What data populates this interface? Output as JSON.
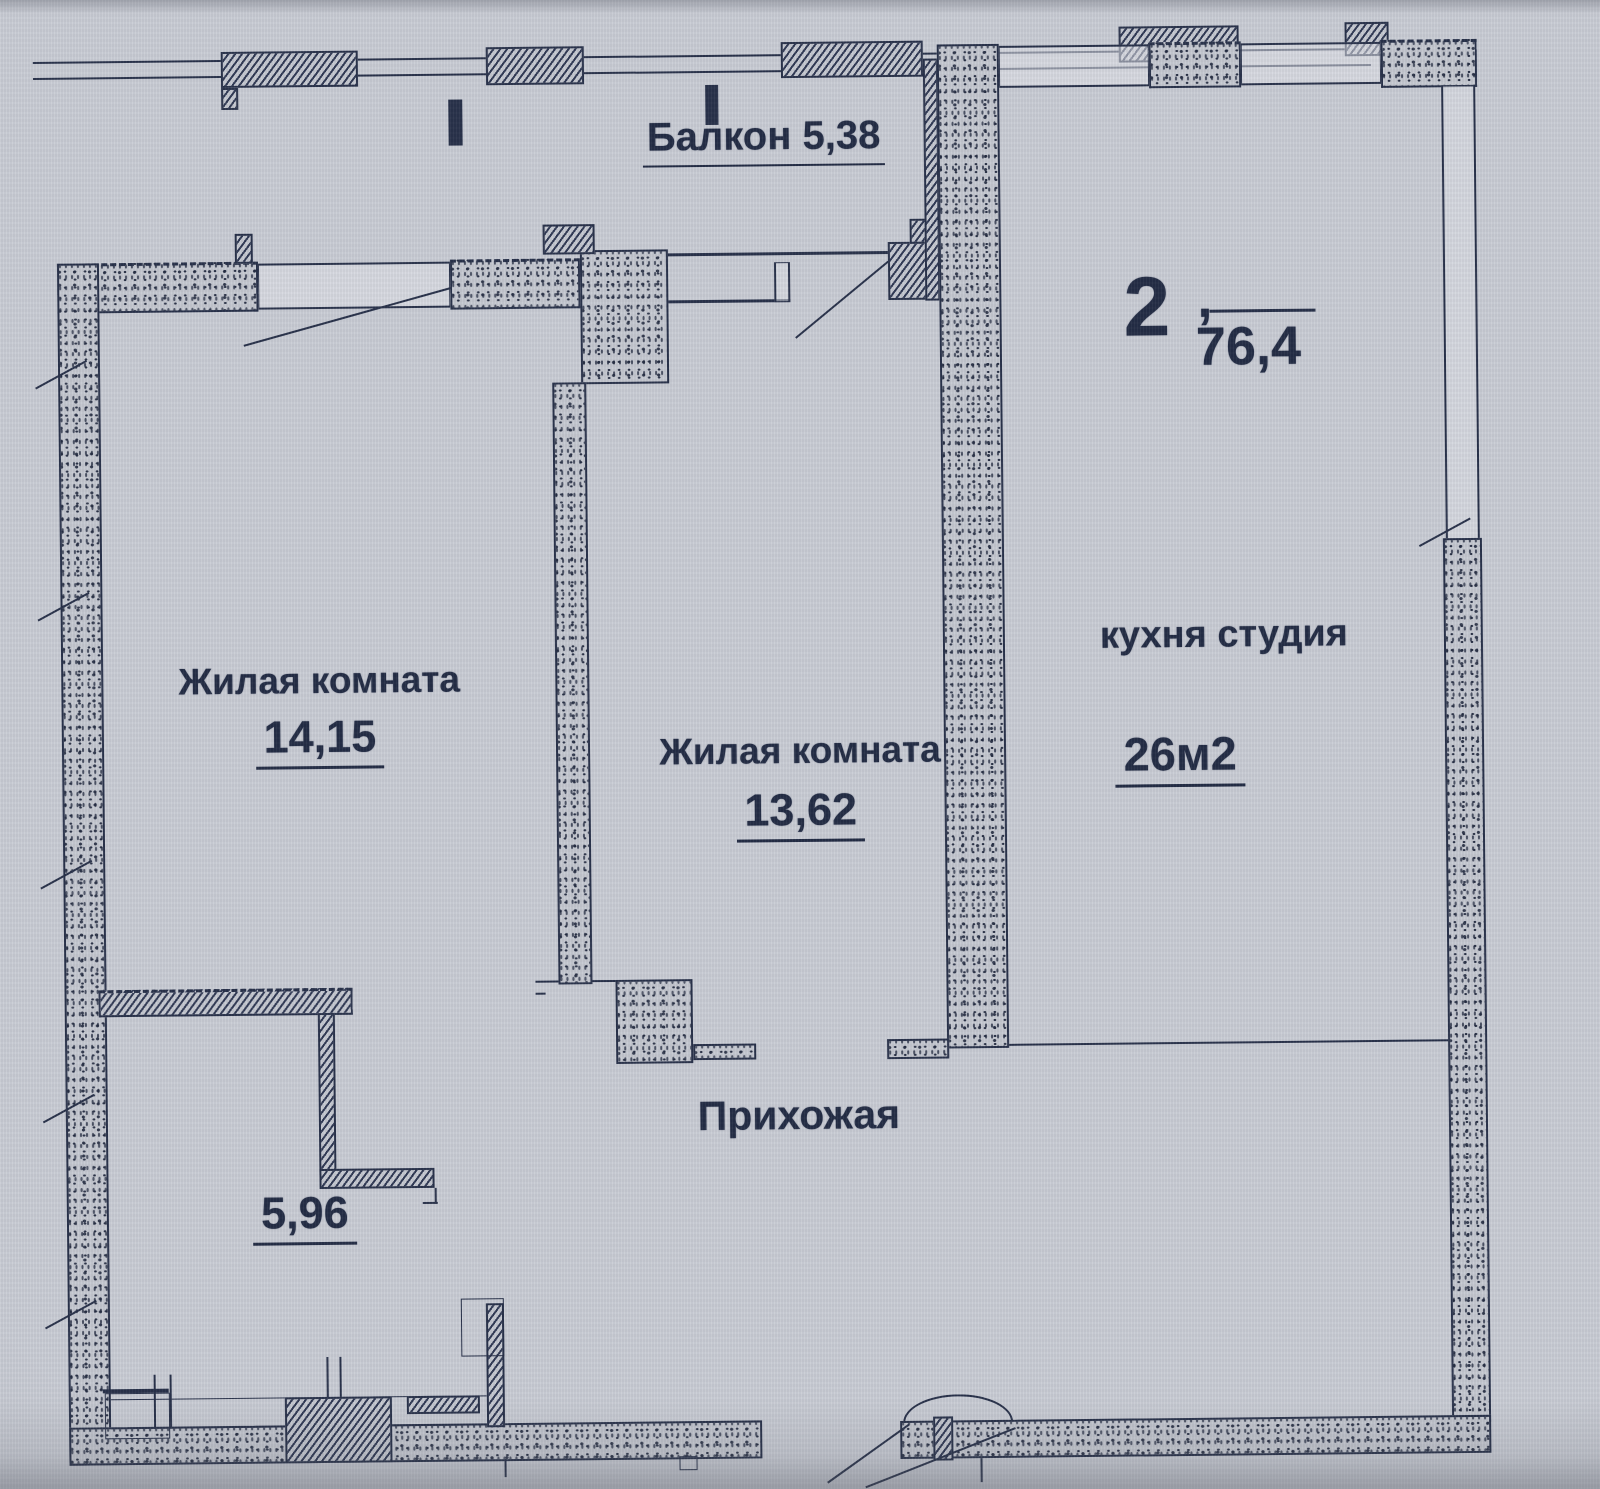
{
  "balcony": {
    "name": "Балкон",
    "area": "5,38"
  },
  "apartment": {
    "rooms": "2",
    "comma": ",",
    "total_area": "76,4"
  },
  "rooms": {
    "living1": {
      "name": "Жилая комната",
      "area": "14,15"
    },
    "living2": {
      "name": "Жилая комната",
      "area": "13,62"
    },
    "kitchen": {
      "name": "кухня студия",
      "area": "26м2"
    },
    "hallway": {
      "name": "Прихожая"
    },
    "bath": {
      "area": "5,96"
    }
  },
  "colors": {
    "ink": "#232c45",
    "paper": "#c9ccd4"
  }
}
